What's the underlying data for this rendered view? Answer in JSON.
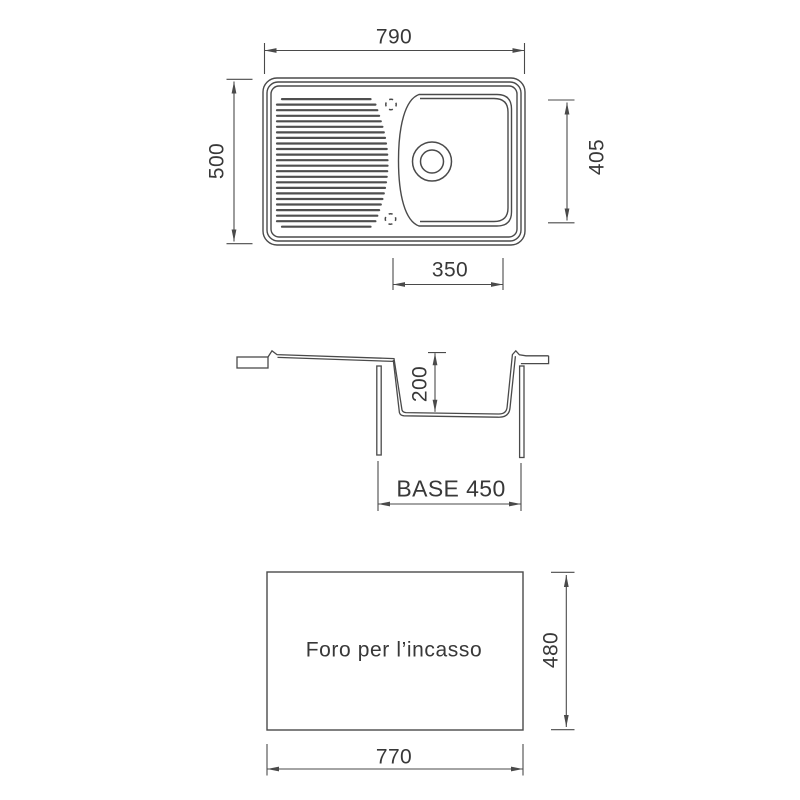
{
  "page": {
    "background": "#ffffff"
  },
  "colors": {
    "line": "#4a4a4a",
    "text": "#383838"
  },
  "views": {
    "top": {
      "name": "top-view",
      "overall_width": "790",
      "overall_depth": "500",
      "bowl_depth": "405",
      "bowl_width": "350"
    },
    "section": {
      "name": "section-view",
      "bowl_height": "200",
      "base_width": "BASE 450"
    },
    "cutout": {
      "name": "cutout-view",
      "caption": "Foro per l’incasso",
      "cutout_width": "770",
      "cutout_height": "480"
    }
  }
}
